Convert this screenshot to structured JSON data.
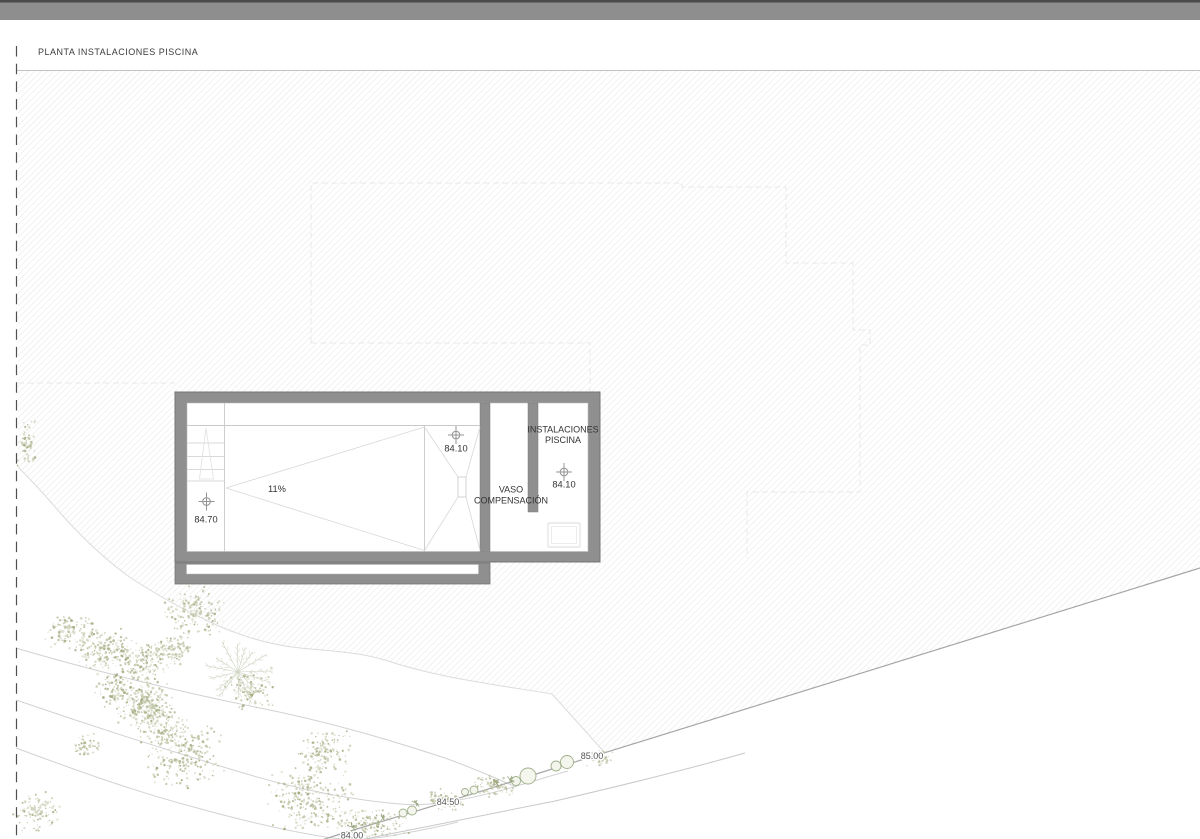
{
  "window": {
    "top_bar_color": "#8e8e8e",
    "top_bar_edge_color": "#4a4a4a"
  },
  "sheet": {
    "title": "PLANTA INSTALACIONES PISCINA"
  },
  "plan": {
    "pool": {
      "slope_label": "11%",
      "shallow_end": {
        "elevation": "84.70"
      },
      "deep_end": {
        "elevation": "84.10"
      }
    },
    "rooms": {
      "vaso_compensacion": {
        "line1": "VASO",
        "line2": "COMPENSACIÓN"
      },
      "instalaciones_piscina": {
        "line1": "INSTALACIONES",
        "line2": "PISCINA",
        "floor_elevation": "84.10"
      }
    },
    "contour_labels": {
      "c85": "85.00",
      "c845": "84.50",
      "c84": "84.00"
    },
    "colors": {
      "wall_gray": "#8f8f8f",
      "hatch_line": "#e6e6e6",
      "boundary_line": "#a6a6a6",
      "contour_line": "#d2d2d2",
      "vegetation_olive": "#b7bd9b",
      "label_text": "#333333"
    }
  }
}
